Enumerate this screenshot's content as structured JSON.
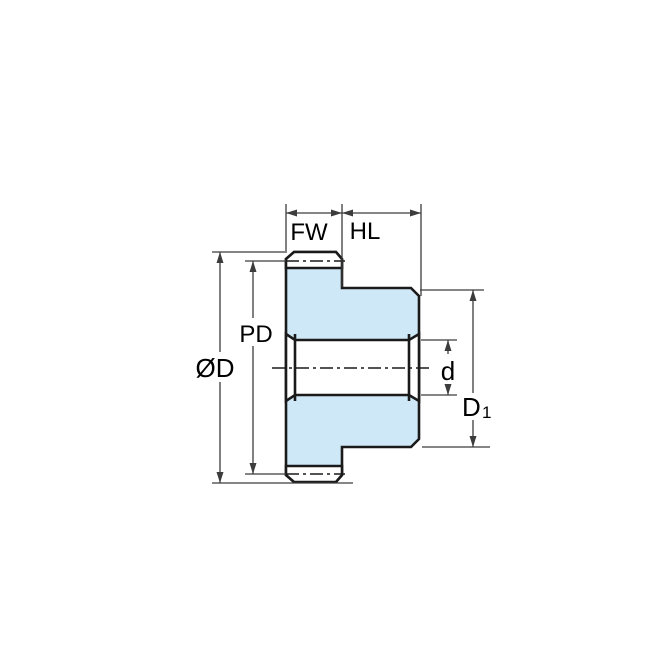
{
  "drawing": {
    "labels": {
      "face_width": "FW",
      "hub_length": "HL",
      "pitch_diameter": "PD",
      "outer_diameter": "ØD",
      "bore_diameter": "d",
      "hub_diameter_main": "D",
      "hub_diameter_sub": "1"
    }
  },
  "colors": {
    "part-fill": "#cfe8f7",
    "outline": "#1a1a1a",
    "dim-line": "#3c3c3c",
    "label-text": "#000000",
    "background": "#ffffff"
  }
}
